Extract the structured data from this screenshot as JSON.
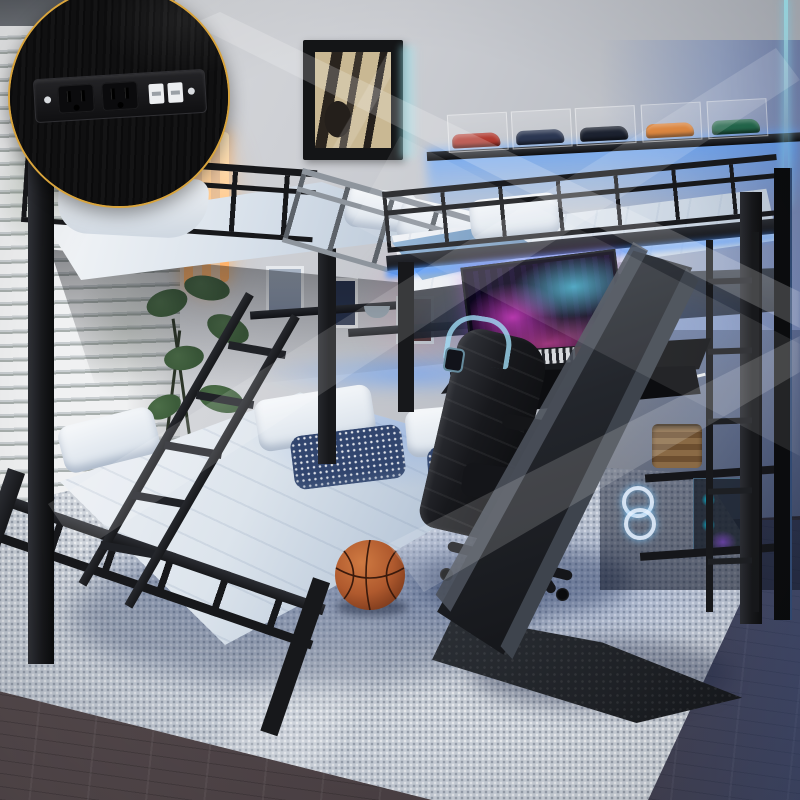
{
  "image": {
    "kind": "product-photo",
    "scene_description": "L-shaped metal bunk bed (twin over full) joined to a loft bed with ladder, slide, built-in charging station inset detail, LED strip lights, car display shelf, gaming desk with neon monitor, gaming chair with headset, plant, basketball and area rug in a kids bedroom"
  },
  "palette": {
    "wall": "#c9ccd1",
    "metal": "#17181b",
    "mattress": "#dce4ec",
    "sheet": "#b7c6d8",
    "led": "#4f96ff",
    "cyan": "#9fe3f0",
    "neon": "#ffe9c2",
    "rug": "#c7cdd5",
    "floor": "#473d41",
    "gold": "#d9a43c",
    "slide": "#23262c",
    "chair": "#17181c",
    "screen-pink": "rgba(225,70,210,.8)",
    "art-beige": "#c9b893",
    "pillow-navy": "#31456e",
    "plant": "#3c5c3a",
    "basket": "#8a6a45",
    "ball-light": "#cf7a42",
    "ball-dark": "#7c3a1c",
    "car-red": "#b03a30",
    "car-navy": "#2c3752",
    "car-black": "#1c2230",
    "car-orange": "#d9731f",
    "car-green": "#24694d"
  },
  "objects": [
    "charging-station-inset",
    "window-blinds",
    "neon-tube-lights",
    "wall-art",
    "car-display-shelf",
    "led-strip",
    "wall-shelves",
    "plant",
    "loft-bed",
    "bunk-bed",
    "bunk-ladder",
    "loft-ladder",
    "slide",
    "gaming-desk",
    "monitor",
    "keyboard",
    "gaming-chair",
    "headset",
    "storage-shelf",
    "basket",
    "gaming-pc",
    "area-rug",
    "wood-floor",
    "basketball",
    "light-beams"
  ]
}
